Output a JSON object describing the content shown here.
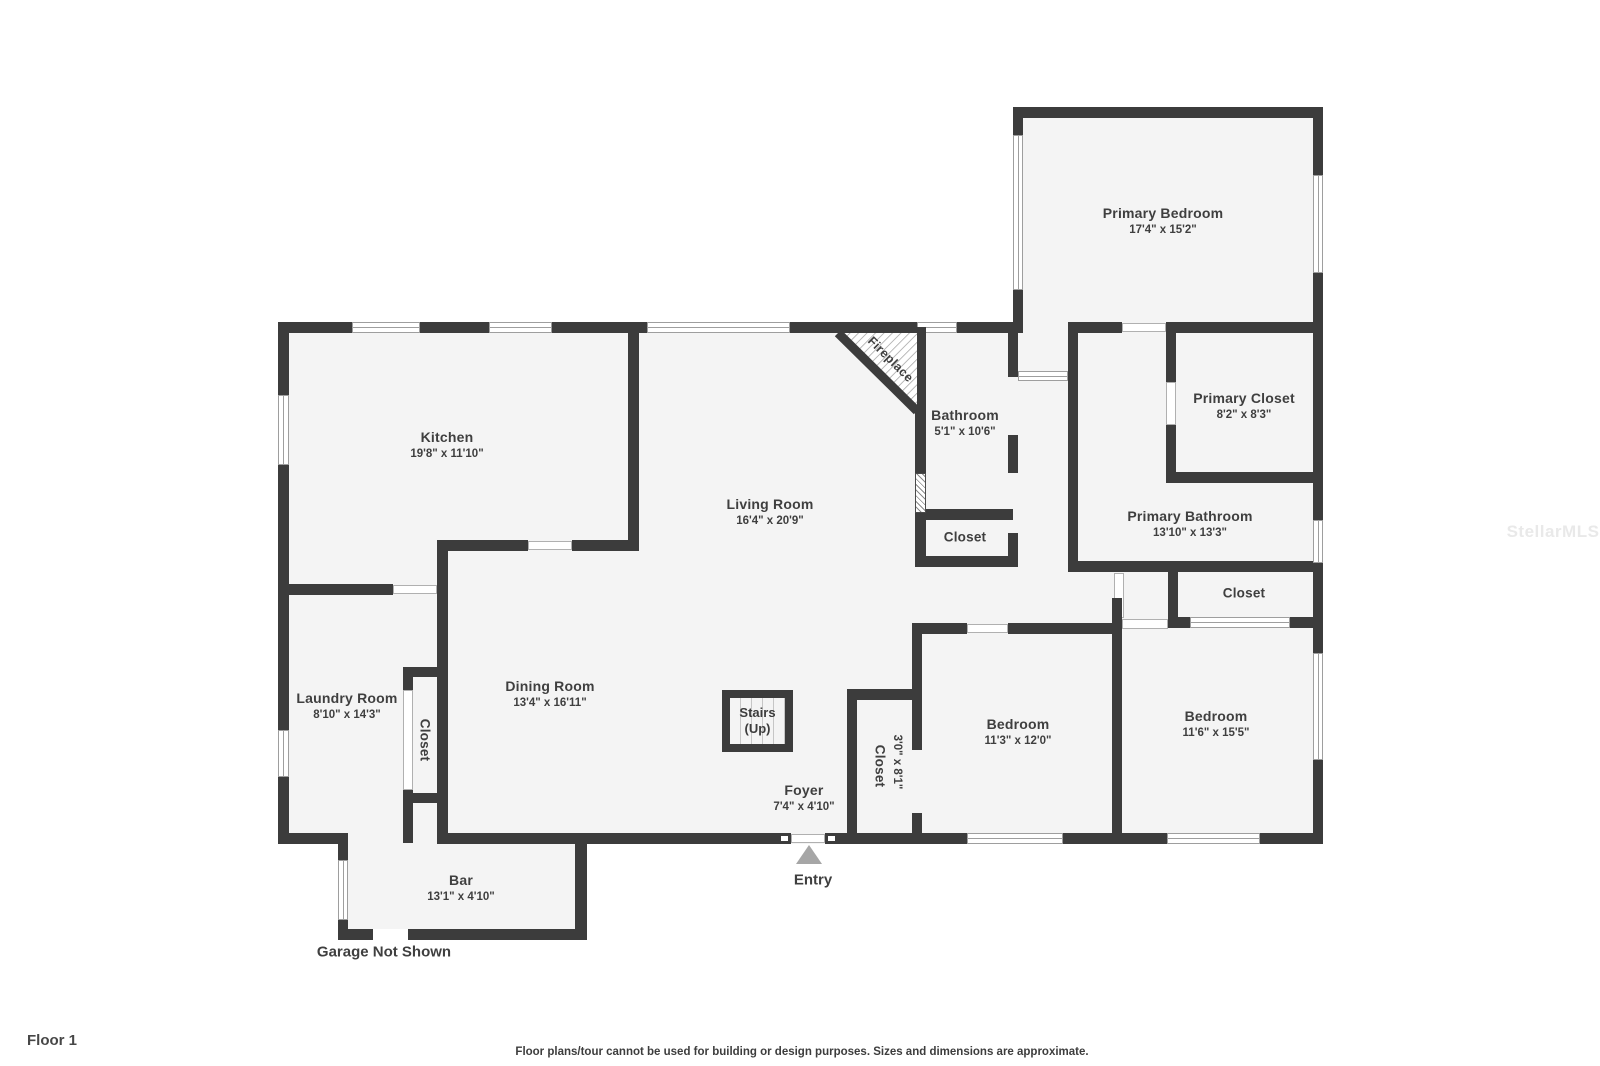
{
  "meta": {
    "floor_label": "Floor 1",
    "disclaimer": "Floor plans/tour cannot be used for building or design purposes. Sizes and dimensions are approximate.",
    "watermark": "StellarMLS"
  },
  "annotations": {
    "entry": "Entry",
    "garage": "Garage Not Shown",
    "fireplace": "Fireplace",
    "stairs_line1": "Stairs",
    "stairs_line2": "(Up)"
  },
  "rooms": {
    "kitchen": {
      "name": "Kitchen",
      "dims": "19'8\" x 11'10\""
    },
    "living_room": {
      "name": "Living Room",
      "dims": "16'4\" x 20'9\""
    },
    "dining_room": {
      "name": "Dining Room",
      "dims": "13'4\" x 16'11\""
    },
    "laundry_room": {
      "name": "Laundry Room",
      "dims": "8'10\" x 14'3\""
    },
    "laundry_closet": {
      "name": "Closet"
    },
    "bar": {
      "name": "Bar",
      "dims": "13'1\" x 4'10\""
    },
    "foyer": {
      "name": "Foyer",
      "dims": "7'4\" x 4'10\""
    },
    "entry_closet": {
      "name": "Closet",
      "dims": "3'0\" x 8'1\""
    },
    "bathroom": {
      "name": "Bathroom",
      "dims": "5'1\" x 10'6\""
    },
    "bathroom_closet": {
      "name": "Closet"
    },
    "bedroom_left": {
      "name": "Bedroom",
      "dims": "11'3\" x 12'0\""
    },
    "bedroom_right": {
      "name": "Bedroom",
      "dims": "11'6\" x 15'5\""
    },
    "primary_bedroom": {
      "name": "Primary Bedroom",
      "dims": "17'4\" x 15'2\""
    },
    "primary_closet": {
      "name": "Primary Closet",
      "dims": "8'2\" x 8'3\""
    },
    "primary_bathroom": {
      "name": "Primary Bathroom",
      "dims": "13'10\" x 13'3\""
    },
    "primary_hall_closet": {
      "name": "Closet"
    }
  },
  "colors": {
    "wall": "#3c3c3c",
    "room_fill": "#f4f4f4",
    "label_text": "#3f3f3f",
    "window_frame": "#9e9e9e",
    "entry_arrow": "#a6a6a6",
    "fireplace_hatch": "#9a9a9a",
    "watermark": "#e9e9e9"
  }
}
